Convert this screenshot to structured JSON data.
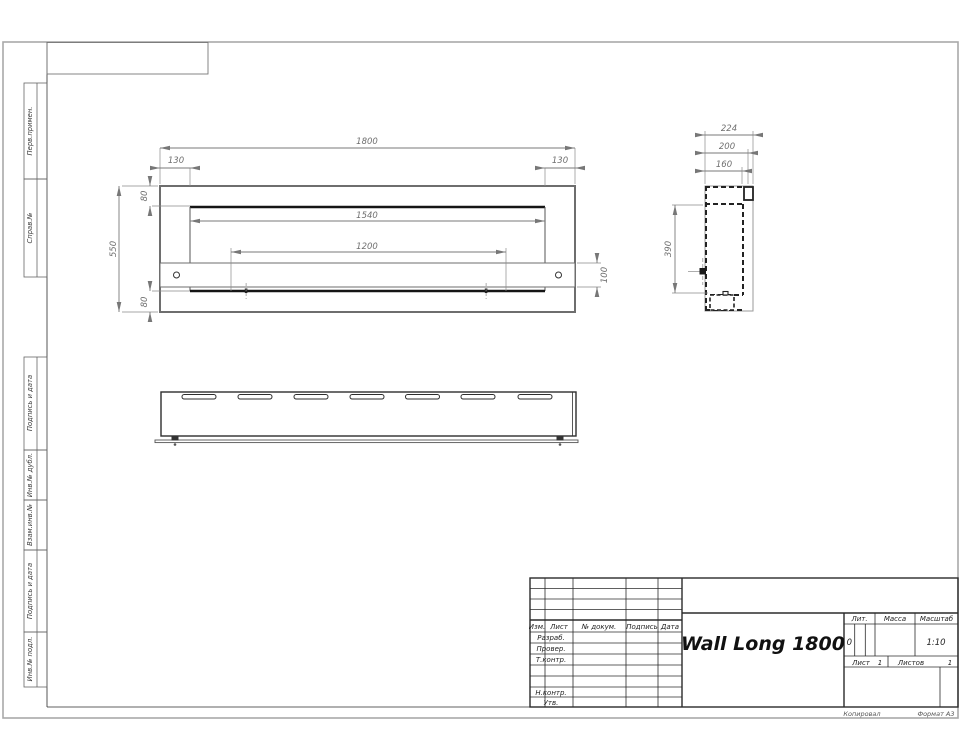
{
  "sheet": {
    "margin_labels": [
      "Перв.примен.",
      "Справ.№",
      "Подпись и дата",
      "Инв.№ дубл.",
      "Взам.инв.№",
      "Подпись и дата",
      "Инв.№ подл."
    ],
    "footer_left": "Копировал",
    "footer_right": "Формат А3"
  },
  "front_view": {
    "width": "1800",
    "offset_left": "130",
    "offset_right": "130",
    "opening_width": "1540",
    "tray_width": "1200",
    "height": "550",
    "top_offset": "80",
    "bottom_offset": "80",
    "tray_height": "100"
  },
  "side_view": {
    "depth": "224",
    "step1": "200",
    "step2": "160",
    "height": "390"
  },
  "title_block": {
    "cols": [
      "Изм.",
      "Лист",
      "№ докум.",
      "Подпись",
      "Дата"
    ],
    "row_labels": [
      "Разраб.",
      "Провер.",
      "Т.контр.",
      "Н.контр.",
      "Утв."
    ],
    "title": "Wall Long 1800",
    "lit_label": "Лит.",
    "lit_value": "0",
    "mass_label": "Масса",
    "scale_label": "Масштаб",
    "scale_value": "1:10",
    "sheet_label": "Лист",
    "sheet_value": "1",
    "sheets_label": "Листов",
    "sheets_value": "1"
  }
}
